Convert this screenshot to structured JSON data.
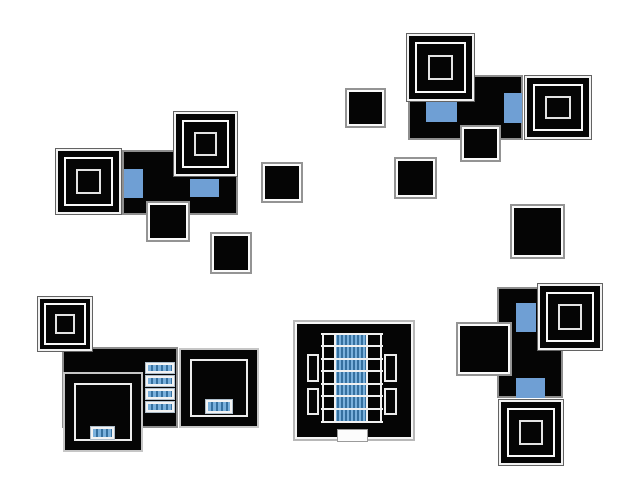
{
  "canvas": {
    "width": 636,
    "height": 503,
    "background": "#ffffff"
  },
  "palette": {
    "ink": "#050505",
    "room_border": "#8e8e8e",
    "white_line": "#f5f5f5",
    "chair_blue": "#6f9fd4",
    "bench_light": "#79b0dc",
    "bench_dark": "#35709f"
  },
  "scene": {
    "description": "top-down floor plan sprites: five furniture clusters and scattered boxes",
    "cluster_count": 5,
    "isolated_box_count": 5
  },
  "shapes": [
    {
      "name": "room-topleft",
      "type": "room",
      "x": 122,
      "y": 150,
      "w": 116,
      "h": 65
    },
    {
      "name": "table-topleft-1",
      "type": "table3",
      "x": 55,
      "y": 148,
      "w": 67,
      "h": 67
    },
    {
      "name": "table-topleft-2",
      "type": "table3",
      "x": 173,
      "y": 111,
      "w": 65,
      "h": 66
    },
    {
      "name": "chair-topleft-1",
      "type": "blue",
      "x": 124,
      "y": 169,
      "w": 19,
      "h": 29
    },
    {
      "name": "chair-topleft-2",
      "type": "blue",
      "x": 190,
      "y": 179,
      "w": 29,
      "h": 18
    },
    {
      "name": "box-topleft",
      "type": "plain",
      "x": 146,
      "y": 201,
      "w": 44,
      "h": 41
    },
    {
      "name": "box-isolated-1",
      "type": "plain",
      "x": 210,
      "y": 232,
      "w": 42,
      "h": 42
    },
    {
      "name": "box-isolated-2",
      "type": "plain",
      "x": 261,
      "y": 162,
      "w": 42,
      "h": 41
    },
    {
      "name": "box-isolated-3",
      "type": "plain",
      "x": 345,
      "y": 88,
      "w": 41,
      "h": 40
    },
    {
      "name": "box-isolated-4",
      "type": "plain",
      "x": 394,
      "y": 157,
      "w": 43,
      "h": 42
    },
    {
      "name": "box-isolated-5",
      "type": "plain",
      "x": 510,
      "y": 204,
      "w": 55,
      "h": 55
    },
    {
      "name": "room-topright",
      "type": "room",
      "x": 408,
      "y": 75,
      "w": 115,
      "h": 65
    },
    {
      "name": "table-topright-1",
      "type": "table3",
      "x": 406,
      "y": 33,
      "w": 69,
      "h": 69
    },
    {
      "name": "table-topright-2",
      "type": "table3",
      "x": 524,
      "y": 75,
      "w": 68,
      "h": 65
    },
    {
      "name": "chair-topright-1",
      "type": "blue",
      "x": 426,
      "y": 102,
      "w": 31,
      "h": 20
    },
    {
      "name": "chair-topright-2",
      "type": "blue",
      "x": 504,
      "y": 93,
      "w": 18,
      "h": 30
    },
    {
      "name": "box-topright",
      "type": "plain",
      "x": 460,
      "y": 125,
      "w": 41,
      "h": 37
    },
    {
      "name": "room-bottomleft",
      "type": "room",
      "x": 62,
      "y": 347,
      "w": 116,
      "h": 81
    },
    {
      "name": "table-bottomleft",
      "type": "table3",
      "x": 37,
      "y": 296,
      "w": 56,
      "h": 56
    },
    {
      "name": "desk-bottomleft-1",
      "type": "table1",
      "x": 63,
      "y": 372,
      "w": 80,
      "h": 80
    },
    {
      "name": "desk-bottomleft-2",
      "type": "table1",
      "x": 179,
      "y": 348,
      "w": 80,
      "h": 80
    },
    {
      "name": "bench-bottomleft-1",
      "type": "bench",
      "x": 146,
      "y": 363,
      "w": 28,
      "h": 10
    },
    {
      "name": "bench-bottomleft-2",
      "type": "bench",
      "x": 146,
      "y": 376,
      "w": 28,
      "h": 10
    },
    {
      "name": "bench-bottomleft-3",
      "type": "bench",
      "x": 146,
      "y": 389,
      "w": 28,
      "h": 10
    },
    {
      "name": "bench-bottomleft-4",
      "type": "bench",
      "x": 146,
      "y": 402,
      "w": 28,
      "h": 10
    },
    {
      "name": "bench-in-desk-1",
      "type": "bench",
      "x": 91,
      "y": 427,
      "w": 23,
      "h": 12
    },
    {
      "name": "bench-in-desk-2",
      "type": "bench",
      "x": 206,
      "y": 400,
      "w": 26,
      "h": 13
    },
    {
      "name": "hall-room",
      "type": "hallout",
      "x": 293,
      "y": 320,
      "w": 122,
      "h": 121
    },
    {
      "name": "hall-slot-1",
      "type": "slot",
      "x": 307,
      "y": 354,
      "w": 12,
      "h": 28
    },
    {
      "name": "hall-slot-2",
      "type": "slot",
      "x": 307,
      "y": 388,
      "w": 12,
      "h": 27
    },
    {
      "name": "hall-slot-3",
      "type": "slot",
      "x": 384,
      "y": 354,
      "w": 13,
      "h": 28
    },
    {
      "name": "hall-slot-4",
      "type": "slot",
      "x": 384,
      "y": 388,
      "w": 13,
      "h": 27
    },
    {
      "name": "hall-long-table",
      "type": "colstripe",
      "x": 335,
      "y": 334,
      "w": 32,
      "h": 88
    },
    {
      "name": "hall-vline-1",
      "type": "vline",
      "x": 322,
      "y": 333,
      "w": 2,
      "h": 90
    },
    {
      "name": "hall-vline-2",
      "type": "vline",
      "x": 334,
      "y": 333,
      "w": 2,
      "h": 90
    },
    {
      "name": "hall-vline-3",
      "type": "vline",
      "x": 366,
      "y": 333,
      "w": 2,
      "h": 90
    },
    {
      "name": "hall-vline-4",
      "type": "vline",
      "x": 380,
      "y": 333,
      "w": 2,
      "h": 90
    },
    {
      "name": "hall-hline-1",
      "type": "hline",
      "x": 321,
      "y": 333,
      "w": 62,
      "h": 2
    },
    {
      "name": "hall-hline-2",
      "type": "hline",
      "x": 321,
      "y": 345,
      "w": 62,
      "h": 2
    },
    {
      "name": "hall-hline-3",
      "type": "hline",
      "x": 321,
      "y": 358,
      "w": 62,
      "h": 2
    },
    {
      "name": "hall-hline-4",
      "type": "hline",
      "x": 321,
      "y": 370,
      "w": 62,
      "h": 2
    },
    {
      "name": "hall-hline-5",
      "type": "hline",
      "x": 321,
      "y": 383,
      "w": 62,
      "h": 2
    },
    {
      "name": "hall-hline-6",
      "type": "hline",
      "x": 321,
      "y": 395,
      "w": 62,
      "h": 2
    },
    {
      "name": "hall-hline-7",
      "type": "hline",
      "x": 321,
      "y": 408,
      "w": 62,
      "h": 2
    },
    {
      "name": "hall-hline-8",
      "type": "hline",
      "x": 321,
      "y": 421,
      "w": 62,
      "h": 2
    },
    {
      "name": "hall-door",
      "type": "door",
      "x": 337,
      "y": 429,
      "w": 31,
      "h": 13
    },
    {
      "name": "room-bottomright",
      "type": "room",
      "x": 497,
      "y": 287,
      "w": 66,
      "h": 111
    },
    {
      "name": "chair-bottomright-1",
      "type": "blue",
      "x": 516,
      "y": 303,
      "w": 20,
      "h": 29
    },
    {
      "name": "chair-bottomright-2",
      "type": "blue",
      "x": 516,
      "y": 378,
      "w": 29,
      "h": 20
    },
    {
      "name": "table-bottomright-1",
      "type": "table3",
      "x": 537,
      "y": 283,
      "w": 66,
      "h": 68
    },
    {
      "name": "box-bottomright",
      "type": "plain",
      "x": 456,
      "y": 322,
      "w": 56,
      "h": 54
    },
    {
      "name": "table-bottomright-2",
      "type": "table3",
      "x": 498,
      "y": 399,
      "w": 66,
      "h": 67
    }
  ]
}
